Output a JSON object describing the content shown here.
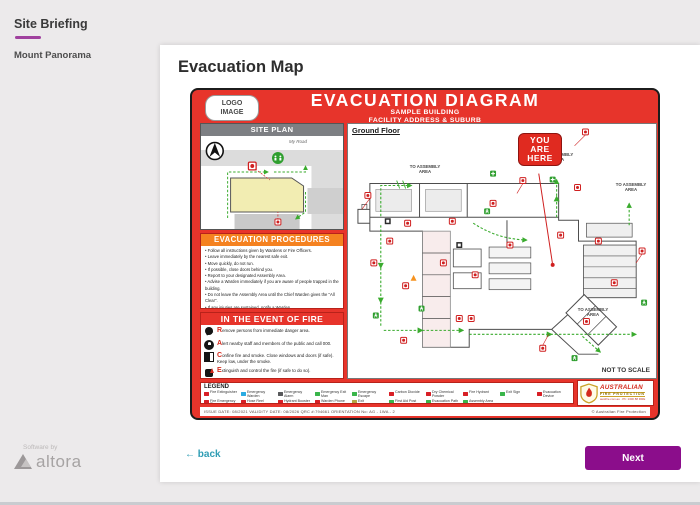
{
  "colors": {
    "accent_purple": "#8b0d8b",
    "sidebar_underline": "#a0419e",
    "back_link": "#2f9db4",
    "diagram_red": "#e7342b",
    "procedures_orange": "#f58220",
    "siteplan_gray": "#7d7f83",
    "path_green": "#3aab2e"
  },
  "sidebar": {
    "title": "Site Briefing",
    "items": [
      {
        "label": "Mount Panorama"
      }
    ]
  },
  "main": {
    "title": "Evacuation Map"
  },
  "nav": {
    "back_arrow": "←",
    "back_label": "back",
    "next_label": "Next"
  },
  "brand": {
    "prefix": "Software by",
    "name": "altora"
  },
  "diagram": {
    "logo_line1": "LOGO",
    "logo_line2": "IMAGE",
    "title": "EVACUATION DIAGRAM",
    "subtitle1": "SAMPLE BUILDING",
    "subtitle2": "FACILITY ADDRESS & SUBURB",
    "site_plan": {
      "title": "SITE PLAN",
      "road_label": "My Road"
    },
    "procedures": {
      "title": "EVACUATION PROCEDURES",
      "items": [
        "Follow all instructions given by Wardens or Fire Officers.",
        "Leave immediately by the nearest safe exit.",
        "Move quickly, do not run.",
        "If possible, close doors behind you.",
        "Report to your designated Assembly Area.",
        "Advise a Warden immediately if you are aware of people trapped in the building.",
        "Do not leave the Assembly Area until the Chief Warden gives the \"All Clear\".",
        "If any injuries are sustained, notify a Warden."
      ]
    },
    "fire": {
      "title": "IN THE EVENT OF FIRE",
      "items": [
        {
          "icon": "fi-run",
          "letter": "R",
          "text": "emove persons from immediate danger area."
        },
        {
          "icon": "fi-alert",
          "letter": "A",
          "text": "lert nearby staff and members of the public and call 000."
        },
        {
          "icon": "fi-door",
          "letter": "C",
          "text": "onfine fire and smoke. Close windows and doors (if safe). Keep low, under the smoke."
        },
        {
          "icon": "fi-ext",
          "letter": "E",
          "text": "xtinguish and control the fire (if safe to do so)."
        }
      ]
    },
    "floor": {
      "title": "Ground Floor",
      "you_are_here": [
        "YOU",
        "ARE",
        "HERE"
      ],
      "assembly_label": "TO ASSEMBLY AREA",
      "not_to_scale": "NOT TO SCALE"
    },
    "legend": {
      "title": "LEGEND",
      "row1": [
        {
          "color": "#d81f26",
          "label": "Fire Extinguisher"
        },
        {
          "color": "#29abe2",
          "label": "Emergency Warden"
        },
        {
          "color": "#58595b",
          "label": "Emergency Alarm"
        },
        {
          "color": "#39b54a",
          "label": "Emergency Exit Man"
        },
        {
          "color": "#39b54a",
          "label": "Emergency Escape"
        },
        {
          "color": "#d81f26",
          "label": "Carbon Dioxide"
        },
        {
          "color": "#d81f26",
          "label": "Dry Chemical Powder"
        },
        {
          "color": "#d81f26",
          "label": "Fire Hydrant"
        },
        {
          "color": "#39b54a",
          "label": "Exit Sign"
        },
        {
          "color": "#d81f26",
          "label": "Evacuation Device"
        }
      ],
      "row2": [
        {
          "color": "#d81f26",
          "label": "Fire Emergency Plan"
        },
        {
          "color": "#d81f26",
          "label": "Hose Reel"
        },
        {
          "color": "#d81f26",
          "label": "Hydrant Booster"
        },
        {
          "color": "#d81f26",
          "label": "Warden Phone"
        },
        {
          "color": "#b5a642",
          "label": "Exit"
        },
        {
          "color": "#39b54a",
          "label": "First Aid Post"
        },
        {
          "color": "#39b54a",
          "label": "Evacuation Path"
        },
        {
          "color": "#39b54a",
          "label": "Assembly Area"
        }
      ]
    },
    "afp": {
      "name_line1": "AUSTRALIAN",
      "name_line2": "FIRE PROTECTION",
      "contact": "austfire.com.au · Ph: 1300 88 FIRE"
    },
    "footer_meta": "ISSUE DATE: 08/2021      VALIDITY DATE: 08/2026      QRC #:794661      ORIENTATION No: AG - 1WA - 2",
    "footer_copyright": "© Australian Fire Protection"
  }
}
